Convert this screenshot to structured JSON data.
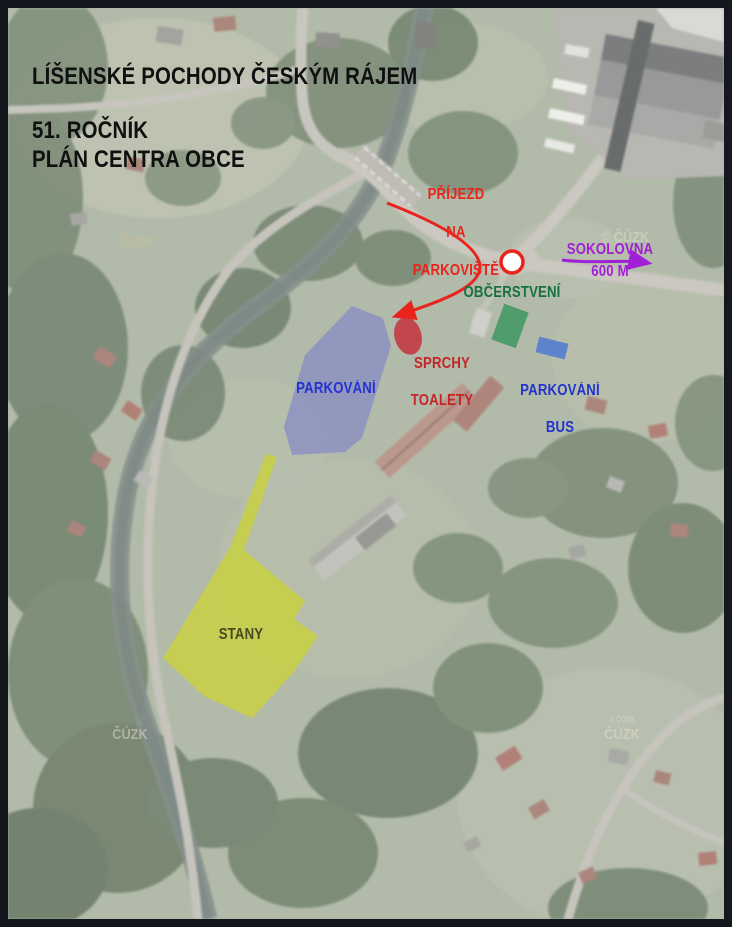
{
  "header": {
    "title_line1": "LÍŠENSKÉ POCHODY ČESKÝM RÁJEM",
    "title_line2": "51. ROČNÍK",
    "subtitle": "PLÁN CENTRA OBCE"
  },
  "labels": {
    "arrival": {
      "lines": [
        "PŘÍJEZD",
        "NA",
        "PARKOVIŠTĚ"
      ],
      "color": "#e8241d"
    },
    "sokolovna": {
      "label": "SOKOLOVNA",
      "distance": "600 M",
      "color": "#a21fd8"
    },
    "refreshments": {
      "label": "OBČERSTVENÍ",
      "color": "#17713e"
    },
    "showers": {
      "line1": "SPRCHY",
      "line2": "TOALETY",
      "color": "#c32528"
    },
    "parking": {
      "label": "PARKOVÁNÍ",
      "color": "#2333cf"
    },
    "parking_bus": {
      "line1": "PARKOVÁNÍ",
      "line2": "BUS",
      "color": "#2333cf"
    },
    "tents": {
      "label": "STANY",
      "color": "#464a21"
    }
  },
  "zones": {
    "parking_area_fill": "#7e81cb",
    "tents_area_fill": "#cbd23c",
    "showers_spot_fill": "#c23a43",
    "refreshments_spot_fill": "#3f9663",
    "bus_parking_spot_fill": "#4d79d2",
    "junction_marker_fill": "#ffffff",
    "junction_marker_stroke": "#e8241d",
    "route_arrow_color": "#e8241d",
    "direction_arrow_color": "#a21fd8"
  },
  "watermark": {
    "text": "ČÚZK",
    "copyright": "© ČÚZK"
  }
}
